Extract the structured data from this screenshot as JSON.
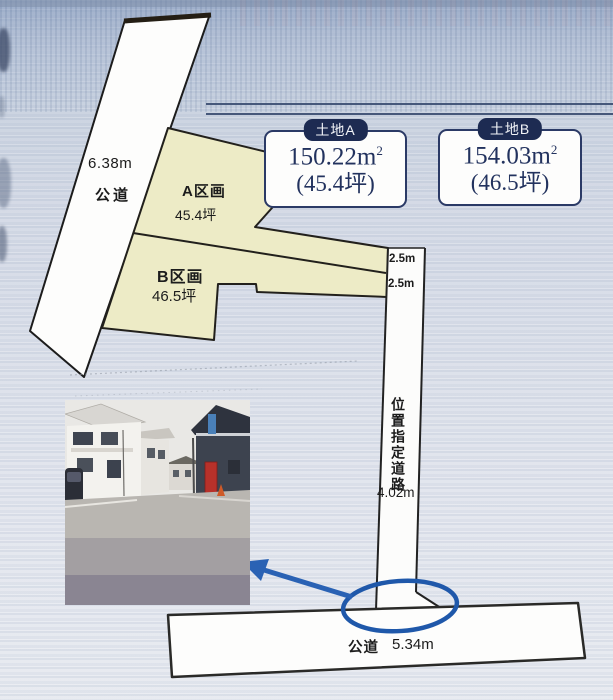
{
  "plan": {
    "left_road": {
      "width_label": "6.38m",
      "name": "公道"
    },
    "parcel_a": {
      "name": "A区画",
      "area": "45.4坪"
    },
    "parcel_b": {
      "name": "B区画",
      "area": "46.5坪"
    },
    "setback_a": "2.5m",
    "setback_b": "2.5m",
    "private_road": {
      "name": "位置指定道路",
      "width_label": "4.02m"
    },
    "bottom_road": {
      "name": "公道",
      "width_label": "5.34m"
    }
  },
  "land_cards": [
    {
      "tag": "土地A",
      "area_m2": "150.22m",
      "area_m2_sup": "2",
      "area_tsubo": "(45.4坪)"
    },
    {
      "tag": "土地B",
      "area_m2": "154.03m",
      "area_m2_sup": "2",
      "area_tsubo": "(46.5坪)"
    }
  ],
  "colors": {
    "parcel_fill": "#edebc6",
    "road_fill": "#fdfdfc",
    "card_navy": "#1d2b52",
    "annotation_blue": "#2a62b4",
    "line_black": "#222222",
    "scan_background": "#cfd7e3"
  }
}
